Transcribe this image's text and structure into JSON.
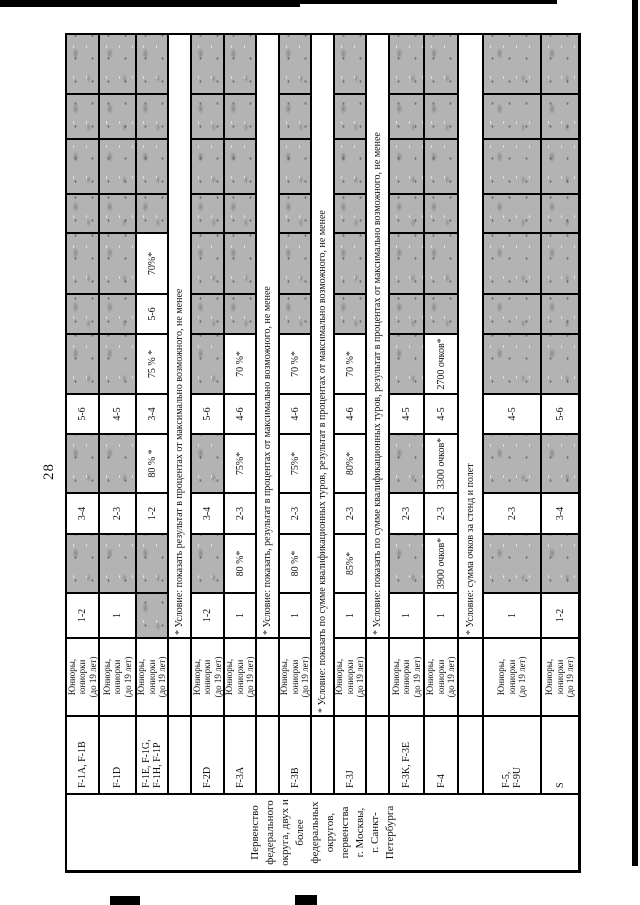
{
  "page": {
    "number": "28"
  },
  "colors": {
    "cell_gray": "#b3b3b3",
    "ink": "#111111",
    "border": "#000000"
  },
  "table": {
    "tournament_header_lines": [
      "Первенство",
      "федерального",
      "округа, двух и",
      "более",
      "федеральных",
      "округов,",
      "первенства",
      "г. Москвы,",
      "г. Санкт-",
      "Петербурга"
    ],
    "age_lines": [
      "Юниоры,",
      "юниорки",
      "(до 19 лет)"
    ],
    "rows": [
      {
        "type": "data",
        "id": "f1a",
        "class_lines": [
          "F-1A, F-1B"
        ],
        "values": [
          "1-2",
          "",
          "3-4",
          "",
          "5-6",
          "",
          "",
          "",
          "",
          "",
          "",
          ""
        ]
      },
      {
        "type": "data",
        "id": "f1d",
        "class_lines": [
          "F-1D"
        ],
        "values": [
          "1",
          "",
          "2-3",
          "",
          "4-5",
          "",
          "",
          "",
          "",
          "",
          "",
          ""
        ]
      },
      {
        "type": "data",
        "id": "f1e",
        "class_lines": [
          "F-1E, F-1G,",
          "F-1H, F-1P"
        ],
        "values": [
          "",
          "",
          "1-2",
          "80 % *",
          "3-4",
          "75 % *",
          "5-6",
          "70%*",
          "",
          "",
          "",
          ""
        ]
      },
      {
        "type": "note",
        "id": "note1",
        "span": "values",
        "text": "* Условие: показать результат в процентах от максимально возможного, не менее"
      },
      {
        "type": "data",
        "id": "f2d",
        "class_lines": [
          "F-2D"
        ],
        "values": [
          "1-2",
          "",
          "3-4",
          "",
          "5-6",
          "",
          "",
          "",
          "",
          "",
          "",
          ""
        ]
      },
      {
        "type": "data",
        "id": "f3a",
        "class_lines": [
          "F-3A"
        ],
        "values": [
          "1",
          "80 %*",
          "2-3",
          "75%*",
          "4-6",
          "70 %*",
          "",
          "",
          "",
          "",
          "",
          ""
        ]
      },
      {
        "type": "note",
        "id": "note2",
        "span": "values",
        "text": "* Условие: показать, результат в процентах от максимально возможного, не менее"
      },
      {
        "type": "data",
        "id": "f3b",
        "class_lines": [
          "F-3B"
        ],
        "values": [
          "1",
          "80 %*",
          "2-3",
          "75%*",
          "4-6",
          "70 %*",
          "",
          "",
          "",
          "",
          "",
          ""
        ]
      },
      {
        "type": "note",
        "id": "note3",
        "span": "age",
        "text": "* Условие: показать по сумме квалификационных туров, результат в процентах от максимально возможного, не менее"
      },
      {
        "type": "data",
        "id": "f3j",
        "class_lines": [
          "F-3J"
        ],
        "values": [
          "1",
          "85%*",
          "2-3",
          "80%*",
          "4-6",
          "70 %*",
          "",
          "",
          "",
          "",
          "",
          ""
        ]
      },
      {
        "type": "note",
        "id": "note4",
        "span": "values",
        "text": "* Условие: показать по сумме квалификационных туров, результат в процентах от максимально возможного, не менее"
      },
      {
        "type": "data",
        "id": "f3k",
        "class_lines": [
          "F-3K, F-3E"
        ],
        "values": [
          "1",
          "",
          "2-3",
          "",
          "4-5",
          "",
          "",
          "",
          "",
          "",
          "",
          ""
        ]
      },
      {
        "type": "data",
        "id": "f4",
        "class_lines": [
          "F-4"
        ],
        "values": [
          "1",
          "3900 очков*",
          "2-3",
          "3300 очков*",
          "4-5",
          "2700 очков*",
          "",
          "",
          "",
          "",
          "",
          ""
        ]
      },
      {
        "type": "note",
        "id": "note5",
        "span": "values",
        "text": "* Условие: сумма очков за стенд и полет"
      },
      {
        "type": "data",
        "id": "f5",
        "class_lines": [
          "F-5,",
          "F-9U"
        ],
        "values": [
          "1",
          "",
          "2-3",
          "",
          "4-5",
          "",
          "",
          "",
          "",
          "",
          "",
          ""
        ]
      },
      {
        "type": "data",
        "id": "s",
        "class_lines": [
          "S"
        ],
        "values": [
          "1-2",
          "",
          "3-4",
          "",
          "5-6",
          "",
          "",
          "",
          "",
          "",
          "",
          ""
        ]
      }
    ]
  }
}
